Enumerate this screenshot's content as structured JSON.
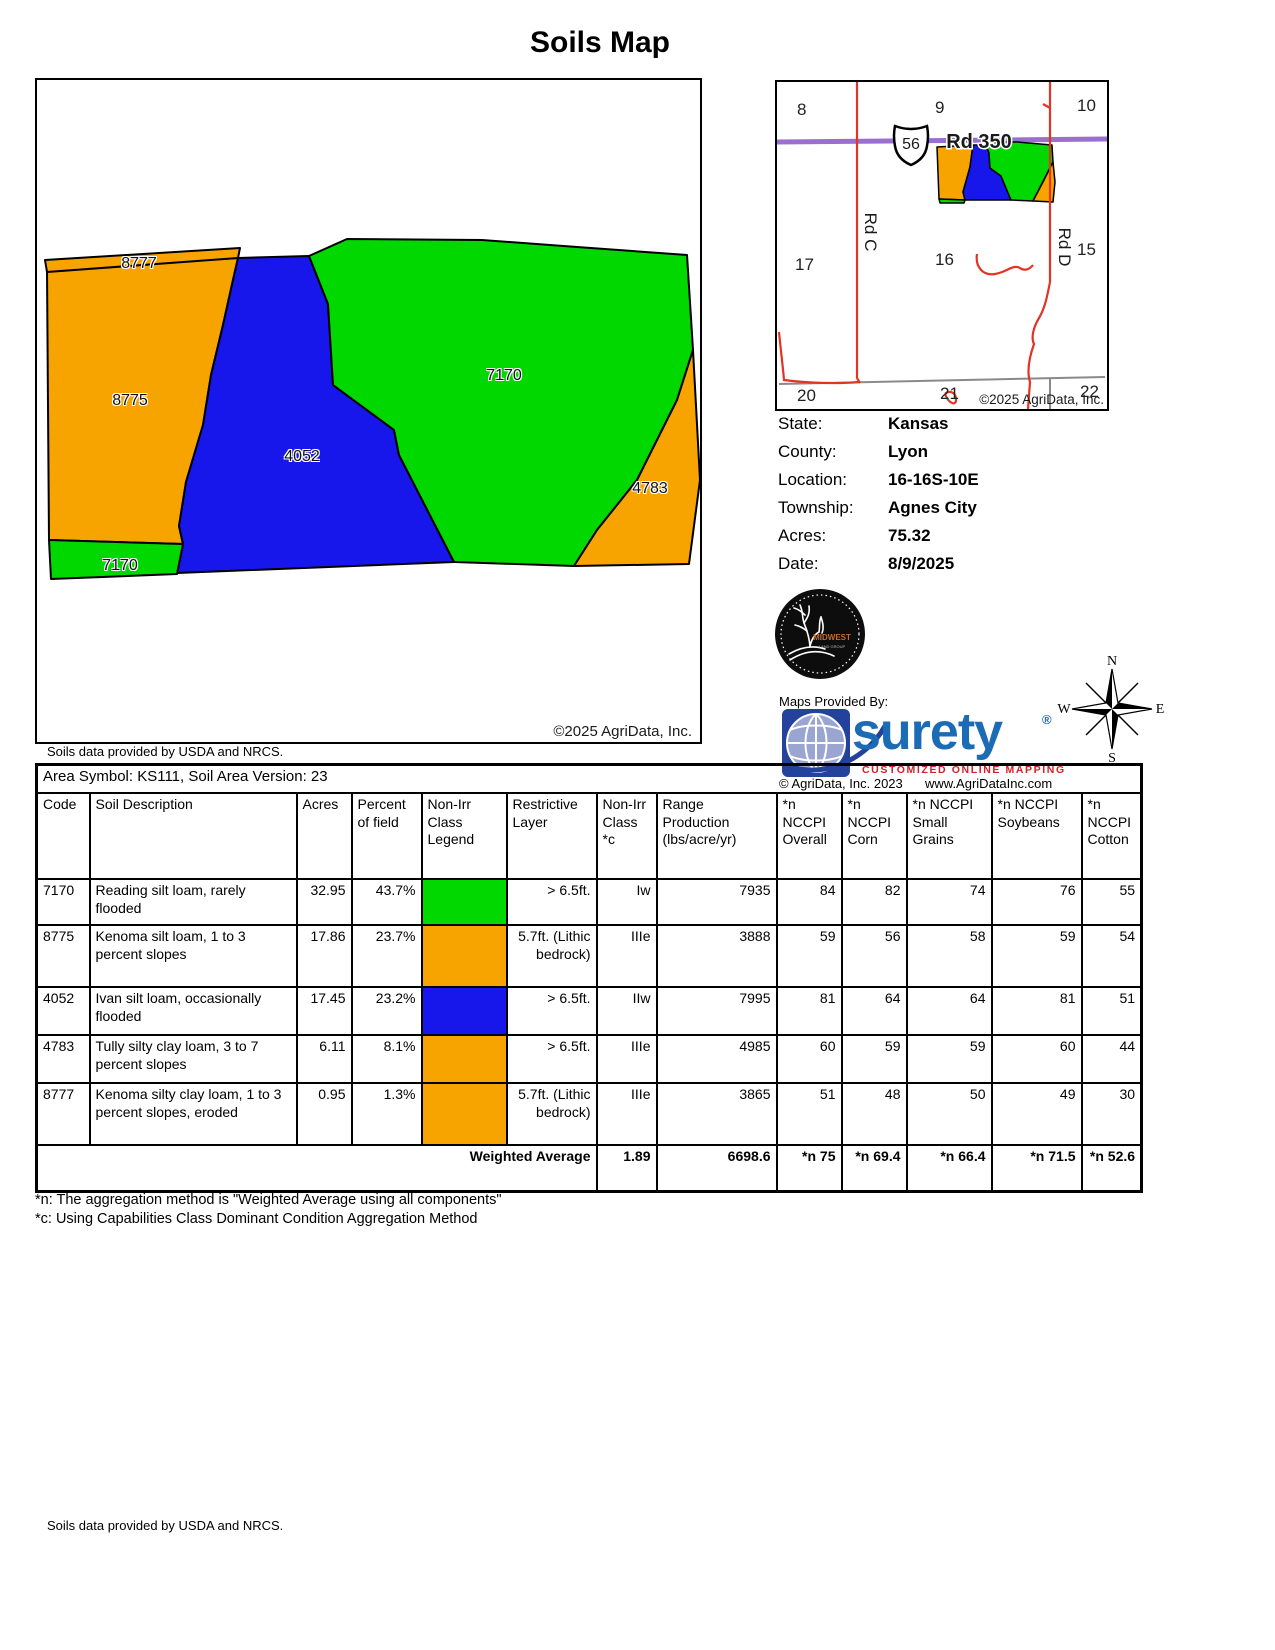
{
  "title": "Soils Map",
  "colors": {
    "green": "#00D800",
    "blue": "#1717EC",
    "orange": "#F7A300",
    "road_purple": "#9B6FD0",
    "road_red": "#E23323",
    "road_gray": "#8A8A8A",
    "surety_blue": "#1B6CB5",
    "surety_dark": "#24419B",
    "globe_fill": "#9BA5D2",
    "tagline_red": "#D42027",
    "midwest_orange": "#C96A28"
  },
  "map": {
    "labels": {
      "l8777": "8777",
      "l8775": "8775",
      "l4052": "4052",
      "l7170": "7170",
      "l4783": "4783",
      "l7170b": "7170"
    },
    "copyright": "©2025 AgriData, Inc.",
    "source_note": "Soils data provided by USDA and NRCS."
  },
  "inset": {
    "sections": {
      "s8": "8",
      "s9": "9",
      "s10": "10",
      "s17": "17",
      "s16": "16",
      "s15": "15",
      "s20": "20",
      "s21": "21",
      "s22": "22"
    },
    "shield": "56",
    "road350": "Rd 350",
    "rdc": "Rd C",
    "rdd": "Rd D",
    "copyright": "©2025 AgriData, Inc."
  },
  "info": {
    "state_label": "State:",
    "state": "Kansas",
    "county_label": "County:",
    "county": "Lyon",
    "location_label": "Location:",
    "location": "16-16S-10E",
    "township_label": "Township:",
    "township": "Agnes City",
    "acres_label": "Acres:",
    "acres": "75.32",
    "date_label": "Date:",
    "date": "8/9/2025"
  },
  "branding": {
    "maps_provided_by": "Maps Provided By:",
    "surety": "surety",
    "reg": "®",
    "tagline": "CUSTOMIZED ONLINE MAPPING",
    "copyright": "© AgriData, Inc. 2023",
    "website": "www.AgriDataInc.com",
    "midwest_line1": "MIDWEST",
    "midwest_line2": "LAND GROUP"
  },
  "compass": {
    "n": "N",
    "e": "E",
    "s": "S",
    "w": "W"
  },
  "table": {
    "area_header": "Area Symbol: KS111, Soil Area Version: 23",
    "columns": [
      "Code",
      "Soil Description",
      "Acres",
      "Percent of field",
      "Non-Irr Class Legend",
      "Restrictive Layer",
      "Non-Irr Class *c",
      "Range Production (lbs/acre/yr)",
      "*n NCCPI Overall",
      "*n NCCPI Corn",
      "*n NCCPI Small Grains",
      "*n NCCPI Soybeans",
      "*n NCCPI Cotton"
    ],
    "rows": [
      {
        "code": "7170",
        "description": "Reading silt loam, rarely flooded",
        "acres": "32.95",
        "percent": "43.7%",
        "legend_color": "#00D800",
        "restrictive": "> 6.5ft.",
        "nonirr_class": "Iw",
        "production": "7935",
        "overall": "84",
        "corn": "82",
        "small_grains": "74",
        "soybeans": "76",
        "cotton": "55"
      },
      {
        "code": "8775",
        "description": "Kenoma silt loam, 1 to 3 percent slopes",
        "acres": "17.86",
        "percent": "23.7%",
        "legend_color": "#F7A300",
        "restrictive": "5.7ft. (Lithic bedrock)",
        "nonirr_class": "IIIe",
        "production": "3888",
        "overall": "59",
        "corn": "56",
        "small_grains": "58",
        "soybeans": "59",
        "cotton": "54"
      },
      {
        "code": "4052",
        "description": "Ivan silt loam, occasionally flooded",
        "acres": "17.45",
        "percent": "23.2%",
        "legend_color": "#1717EC",
        "restrictive": "> 6.5ft.",
        "nonirr_class": "IIw",
        "production": "7995",
        "overall": "81",
        "corn": "64",
        "small_grains": "64",
        "soybeans": "81",
        "cotton": "51"
      },
      {
        "code": "4783",
        "description": "Tully silty clay loam, 3 to 7 percent slopes",
        "acres": "6.11",
        "percent": "8.1%",
        "legend_color": "#F7A300",
        "restrictive": "> 6.5ft.",
        "nonirr_class": "IIIe",
        "production": "4985",
        "overall": "60",
        "corn": "59",
        "small_grains": "59",
        "soybeans": "60",
        "cotton": "44"
      },
      {
        "code": "8777",
        "description": "Kenoma silty clay loam, 1 to 3 percent slopes, eroded",
        "acres": "0.95",
        "percent": "1.3%",
        "legend_color": "#F7A300",
        "restrictive": "5.7ft. (Lithic bedrock)",
        "nonirr_class": "IIIe",
        "production": "3865",
        "overall": "51",
        "corn": "48",
        "small_grains": "50",
        "soybeans": "49",
        "cotton": "30"
      }
    ],
    "weighted": {
      "label": "Weighted Average",
      "nonirr_class": "1.89",
      "production": "6698.6",
      "overall": "*n 75",
      "corn": "*n 69.4",
      "small_grains": "*n 66.4",
      "soybeans": "*n 71.5",
      "cotton": "*n 52.6"
    }
  },
  "footnotes": {
    "n": "*n: The aggregation method is \"Weighted Average using all components\"",
    "c": "*c: Using Capabilities Class Dominant Condition Aggregation Method"
  },
  "footer": "Soils data provided by USDA and NRCS."
}
